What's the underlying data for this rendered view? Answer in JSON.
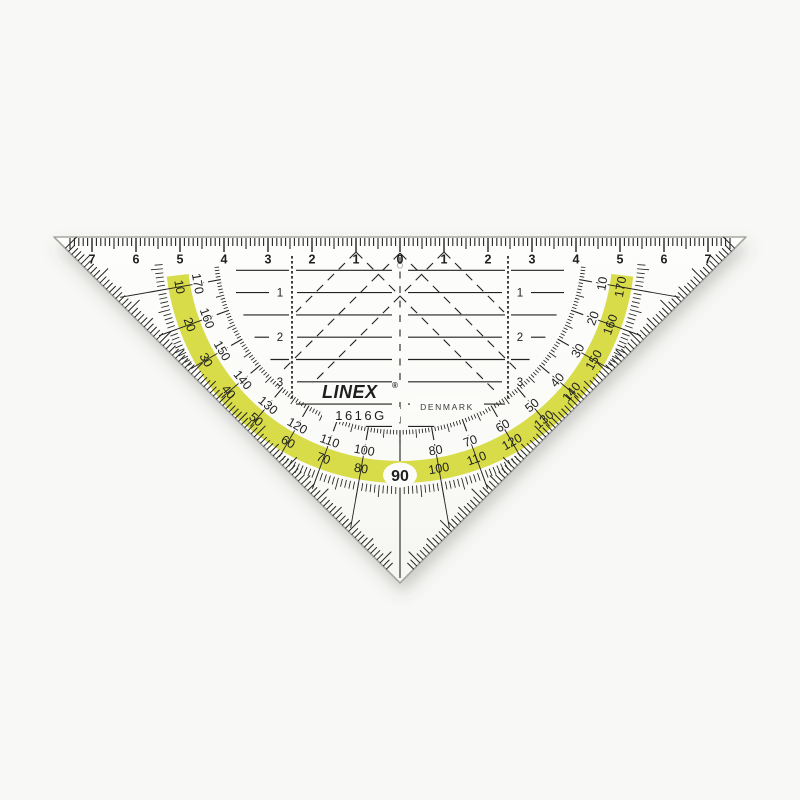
{
  "product": {
    "brand": "LINEX",
    "registered_mark": "®",
    "model": "1616G",
    "country": "DENMARK"
  },
  "top_ruler": {
    "unit": "cm",
    "numbers": [
      "7",
      "6",
      "5",
      "4",
      "3",
      "2",
      "1",
      "0",
      "1",
      "2",
      "3",
      "4",
      "5",
      "6",
      "7"
    ]
  },
  "parallel_grid": {
    "left_row_labels": [
      "1",
      "2",
      "3"
    ],
    "right_row_labels": [
      "1",
      "2",
      "3"
    ]
  },
  "protractor": {
    "degrees": [
      10,
      20,
      30,
      40,
      50,
      60,
      70,
      80,
      100,
      110,
      120,
      130,
      140,
      150,
      160,
      170
    ],
    "inner_scale_labels": [
      "10",
      "20",
      "30",
      "40",
      "50",
      "60",
      "70",
      "80",
      "100",
      "110",
      "120",
      "130",
      "140",
      "150",
      "160",
      "170"
    ],
    "outer_scale_labels": [
      "170",
      "160",
      "150",
      "140",
      "130",
      "120",
      "110",
      "100",
      "80",
      "70",
      "60",
      "50",
      "40",
      "30",
      "20",
      "10"
    ],
    "shared_center_label": "90"
  },
  "colors": {
    "highlight_band": "#d8dc48",
    "band_text": "#4a520e",
    "ink": "#222222",
    "plastic_edge": "#a6a6a1",
    "plastic_fill": "#fcfcfa",
    "background": "#f8f8f6"
  }
}
